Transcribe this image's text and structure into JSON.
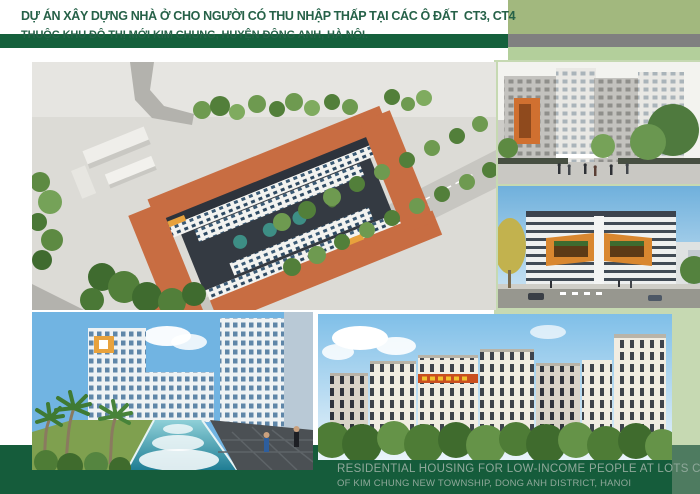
{
  "header": {
    "title_line1": "DỰ ÁN XÂY DỰNG NHÀ Ở CHO NGƯỜI CÓ THU NHẬP THẤP TẠI CÁC Ô ĐẤT  CT3, CT4",
    "title_line2": "THUỘC KHU ĐÔ THỊ MỚI KIM CHUNG, HUYỆN ĐÔNG ANH, HÀ NỘI."
  },
  "footer": {
    "line1": "RESIDENTIAL HOUSING FOR LOW-INCOME PEOPLE AT LOTS CT3, CT4",
    "line2": "OF KIM CHUNG NEW TOWNSHIP, DONG ANH DISTRICT, HANOI"
  },
  "images": {
    "aerial": "aerial-masterplan-render",
    "street": "street-level-towers-render",
    "balcony": "orange-balcony-building-render",
    "pool": "courtyard-pool-render",
    "towers": "apartment-towers-row-render"
  },
  "colors": {
    "title_text": "#266148",
    "header_bar_dark": "#15603C",
    "header_block_sage": "#A2B87E",
    "header_bar_gray": "#808080",
    "header_bar_light": "#B3CF9B",
    "canvas_left": "#FFFFFF",
    "canvas_right": "#C6D9B2",
    "footer_bar": "#155C3B",
    "footer_text": "#8FA89A",
    "corner_block": "#4E7B60"
  }
}
